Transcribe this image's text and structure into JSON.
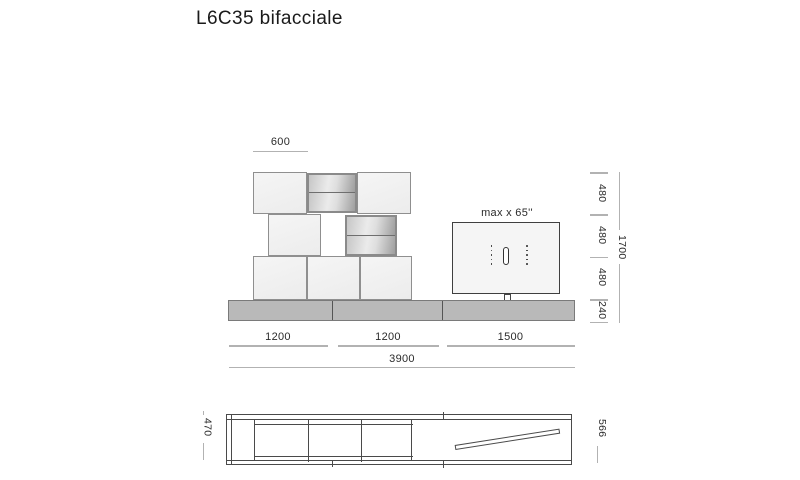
{
  "title": "L6C35 bifacciale",
  "elevation": {
    "tv_label": "max x 65''"
  },
  "dims": {
    "top_module": "600",
    "right_segments": [
      "480",
      "480",
      "480",
      "240"
    ],
    "right_total": "1700",
    "bottom_segments": [
      "1200",
      "1200",
      "1500"
    ],
    "bottom_total": "3900",
    "plan_left": "470",
    "plan_right": "566"
  },
  "colors": {
    "text": "#2b2b2b",
    "dim_line": "#b2b2b2",
    "box_border": "#8f8f8f",
    "box_fill": "#f2f2f2",
    "drawer_border": "#8a8a8a",
    "base_fill": "#b9b9b9",
    "base_border": "#7a7a7a",
    "base_divider": "#555555",
    "tv_border": "#3f3f3f",
    "plan_line": "#4a4a4a"
  }
}
